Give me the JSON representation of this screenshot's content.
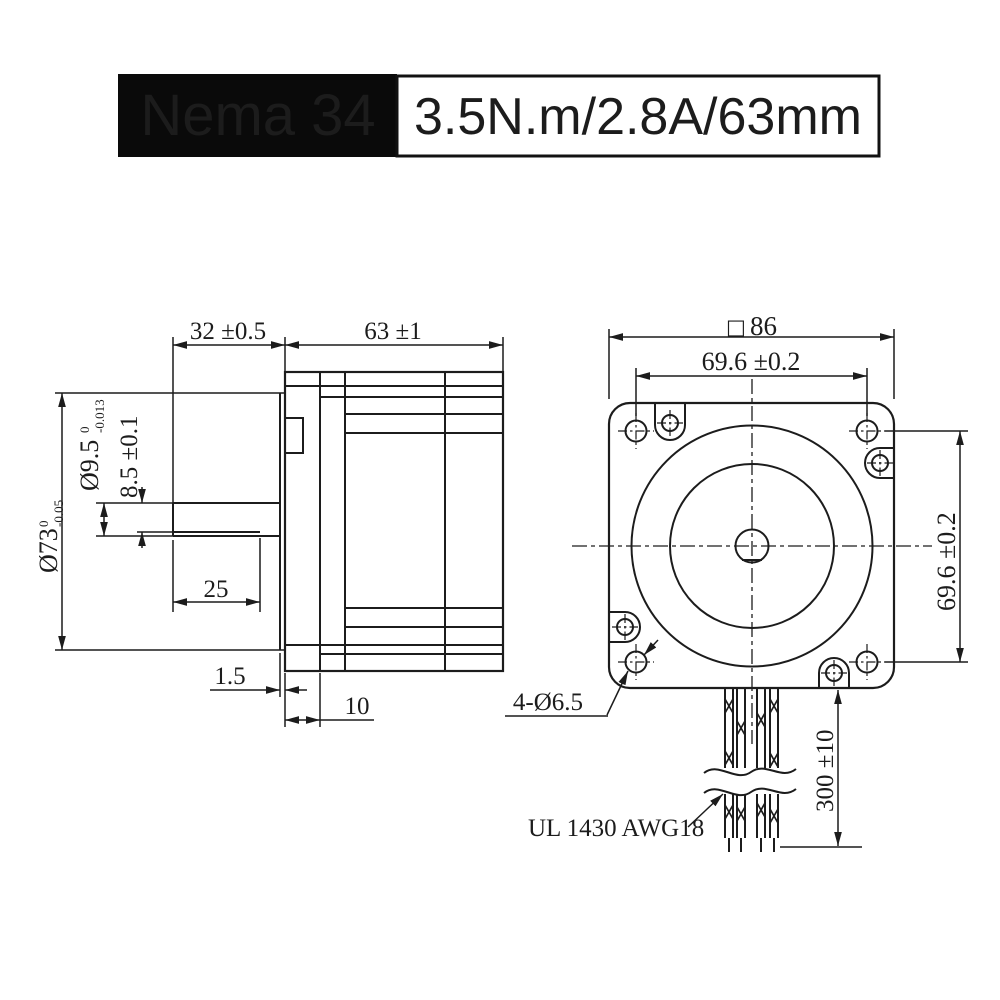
{
  "header": {
    "model": "Nema 34",
    "spec": "3.5N.m/2.8A/63mm"
  },
  "side_view": {
    "dims": {
      "shaft_length": "32 ±0.5",
      "body_length": "63 ±1",
      "shaft_diameter": "Ø9.5",
      "shaft_diameter_tol_upper": "0",
      "shaft_diameter_tol_lower": "-0.013",
      "shaft_flat_height": "8.5 ±0.1",
      "pilot_diameter": "Ø73",
      "pilot_diameter_tol_upper": "0",
      "pilot_diameter_tol_lower": "-0.05",
      "shaft_flat_length": "25",
      "pilot_boss_depth": "1.5",
      "front_flange_depth": "10"
    }
  },
  "front_view": {
    "dims": {
      "square_symbol": "□",
      "square_size": "86",
      "hole_spacing_horizontal": "69.6 ±0.2",
      "hole_spacing_vertical": "69.6 ±0.2",
      "mounting_holes": "4-Ø6.5",
      "lead_length": "300 ±10",
      "wire_spec": "UL 1430 AWG18"
    }
  }
}
